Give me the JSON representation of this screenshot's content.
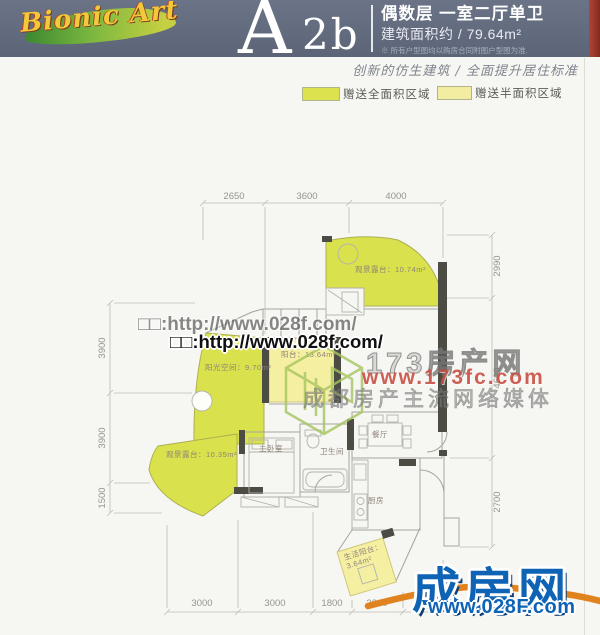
{
  "header": {
    "logo_text": "Bionic Art",
    "unit_letter": "A",
    "unit_suffix": "2b",
    "title": "偶数层 一室二厅单卫",
    "area_line": "建筑面积约 / 79.64m²",
    "disclaimer": "※ 所有户型图均以购房合同附图户型图为准.",
    "slogan": "创新的仿生建筑 / 全面提升居住标准"
  },
  "legend": {
    "full_area_label": "赠送全面积区域",
    "half_area_label": "赠送半面积区域",
    "full_area_color": "#dce24d",
    "half_area_color": "#f3eda1"
  },
  "floorplan": {
    "rooms": {
      "terrace_top": "观景露台：10.74m²",
      "sun_space": "阳光空间：9.70m²",
      "balcony": "阳台：13.64m²",
      "terrace_bottom": "观景露台：10.35m²",
      "master_bedroom": "主卧室",
      "bathroom": "卫生间",
      "dining": "餐厅",
      "kitchen": "厨房",
      "living_balcony_line1": "生活阳台：",
      "living_balcony_line2": "3.64m²"
    },
    "dimensions": {
      "top": [
        "2650",
        "3600",
        "4000"
      ],
      "left": [
        "3900",
        "3900",
        "1500"
      ],
      "right": [
        "2990",
        "4600",
        "2700"
      ],
      "bottom": [
        "3000",
        "3000",
        "1800",
        "2300",
        "1700"
      ]
    }
  },
  "watermarks": {
    "url_ghost": "□□:http://www.028f.com/",
    "url_main": "□□:http://www.028f.com/",
    "brand_173": "173房产网",
    "brand_173_url": "www.173fc.com",
    "brand_173_slogan": "成都房产主流网络媒体",
    "chengfang_name": "成房网",
    "chengfang_url": "www.028F.com"
  },
  "colors": {
    "header_bg": "#5c6477",
    "chengfang_blue": "#0f63b5",
    "swoosh_orange": "#e0831f",
    "watermark_red": "#c94f43"
  }
}
